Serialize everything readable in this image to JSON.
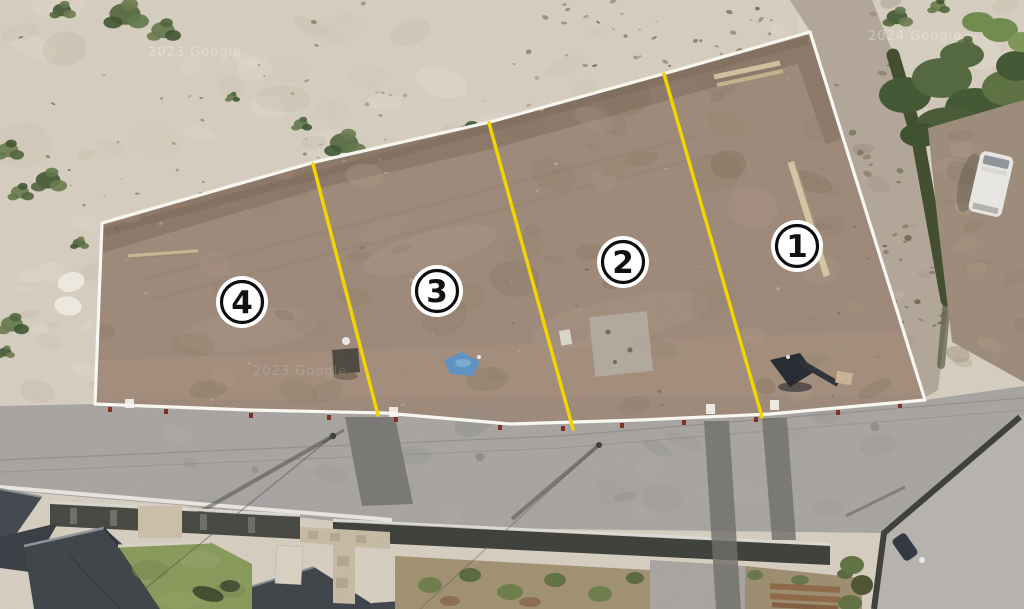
{
  "map": {
    "lots": [
      {
        "label": "1"
      },
      {
        "label": "2"
      },
      {
        "label": "3"
      },
      {
        "label": "4"
      }
    ],
    "colors": {
      "lot_divider": "#f2d400",
      "parcel_boundary": "#f8f6f0",
      "lot_label_bg": "#ffffff",
      "lot_label_ring": "#0d0d0d",
      "lot_label_fg": "#111111"
    },
    "watermarks": [
      {
        "text": "2023 Google"
      },
      {
        "text": "2024 Google"
      },
      {
        "text": "2023 Google"
      }
    ]
  }
}
